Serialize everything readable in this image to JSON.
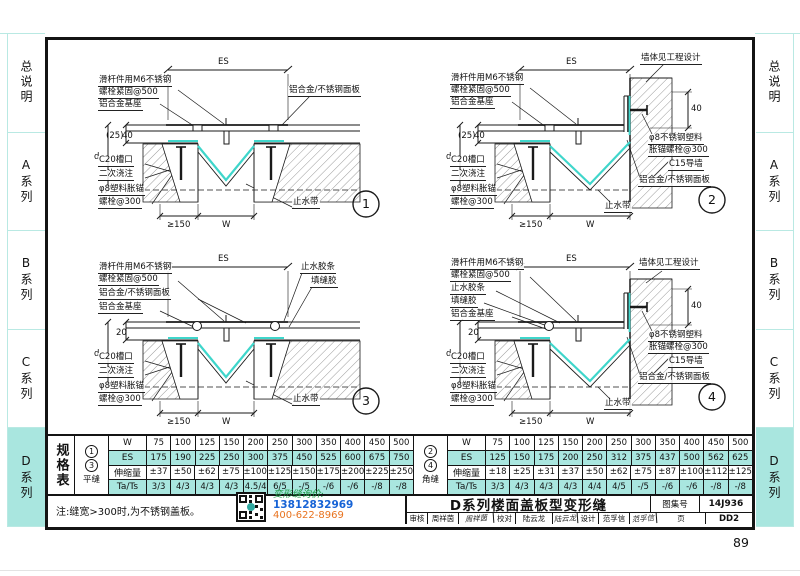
{
  "page_number": "89",
  "colors": {
    "accent_cyan": "#a9e6df",
    "waterstop_cyan": "#3fd6cb",
    "line_black": "#141414"
  },
  "sidebar": {
    "items": [
      {
        "label": "总说明",
        "active": false
      },
      {
        "label": "A系列",
        "active": false
      },
      {
        "label": "B系列",
        "active": false
      },
      {
        "label": "C系列",
        "active": false
      },
      {
        "label": "D系列",
        "active": true
      }
    ]
  },
  "details": [
    {
      "number": "1",
      "dims": {
        "es": "ES",
        "d": "d",
        "h1": "(25)",
        "h2": "40",
        "min": "≥150",
        "w": "W"
      },
      "labels": {
        "slider1": "滑杆件用M6不锈钢",
        "slider2": "螺栓紧固@500",
        "base": "铝合金基座",
        "panel": "铝合金/不锈钢面板",
        "notch": "C20槽口",
        "pour": "二次浇注",
        "anchor1": "φ8塑料胀锚",
        "anchor2": "螺栓@300",
        "waterstop": "止水带"
      }
    },
    {
      "number": "2",
      "dims": {
        "es": "ES",
        "d": "d",
        "h1": "(25)",
        "h2": "40",
        "wall_h": "40",
        "min": "≥150",
        "w": "W"
      },
      "labels": {
        "slider1": "滑杆件用M6不锈钢",
        "slider2": "螺栓紧固@500",
        "base": "铝合金基座",
        "wall": "墙体见工程设计",
        "wall_anchor1": "φ8不锈钢塑料",
        "wall_anchor2": "胀锚螺栓@300",
        "guide_wall": "C15导墙",
        "panel": "铝合金/不锈钢面板",
        "notch": "C20槽口",
        "pour": "二次浇注",
        "anchor1": "φ8塑料胀锚",
        "anchor2": "螺栓@300",
        "waterstop": "止水带"
      }
    },
    {
      "number": "3",
      "dims": {
        "es": "ES",
        "d": "d",
        "h1": "20",
        "min": "≥150",
        "w": "W"
      },
      "labels": {
        "slider1": "滑杆件用M6不锈钢",
        "slider2": "螺栓紧固@500",
        "panel": "铝合金/不锈钢面板",
        "base": "铝合金基座",
        "seal": "止水胶条",
        "caulk": "填缝胶",
        "notch": "C20槽口",
        "pour": "二次浇注",
        "anchor1": "φ8塑料胀锚",
        "anchor2": "螺栓@300",
        "waterstop": "止水带"
      }
    },
    {
      "number": "4",
      "dims": {
        "es": "ES",
        "d": "d",
        "h1": "20",
        "wall_h": "40",
        "min": "≥150",
        "w": "W"
      },
      "labels": {
        "slider1": "滑杆件用M6不锈钢",
        "slider2": "螺栓紧固@500",
        "seal": "止水胶条",
        "caulk": "填缝胶",
        "base": "铝合金基座",
        "wall": "墙体见工程设计",
        "wall_anchor1": "φ8不锈钢塑料",
        "wall_anchor2": "胀锚螺栓@300",
        "guide_wall": "C15导墙",
        "panel": "铝合金/不锈钢面板",
        "notch": "C20槽口",
        "pour": "二次浇注",
        "anchor1": "φ8塑料胀锚",
        "anchor2": "螺栓@300",
        "waterstop": "止水带"
      }
    }
  ],
  "spec_table": {
    "title": "规格表",
    "groups": [
      {
        "marks": [
          "1",
          "3"
        ],
        "type_label": "平缝",
        "rows": [
          {
            "label": "W",
            "values": [
              "75",
              "100",
              "125",
              "150",
              "200",
              "250",
              "300",
              "350",
              "400",
              "450",
              "500"
            ]
          },
          {
            "label": "ES",
            "values": [
              "175",
              "190",
              "225",
              "250",
              "300",
              "375",
              "450",
              "525",
              "600",
              "675",
              "750"
            ]
          },
          {
            "label": "伸缩量",
            "values": [
              "±37",
              "±50",
              "±62",
              "±75",
              "±100",
              "±125",
              "±150",
              "±175",
              "±200",
              "±225",
              "±250"
            ]
          },
          {
            "label": "Ta/Ts",
            "values": [
              "3/3",
              "4/3",
              "4/3",
              "4/3",
              "4.5/4",
              "6/5",
              "-/5",
              "-/6",
              "-/6",
              "-/8",
              "-/8"
            ]
          }
        ]
      },
      {
        "marks": [
          "2",
          "4"
        ],
        "type_label": "角缝",
        "rows": [
          {
            "label": "W",
            "values": [
              "75",
              "100",
              "125",
              "150",
              "200",
              "250",
              "300",
              "350",
              "400",
              "450",
              "500"
            ]
          },
          {
            "label": "ES",
            "values": [
              "125",
              "150",
              "175",
              "200",
              "250",
              "312",
              "375",
              "437",
              "500",
              "562",
              "625"
            ]
          },
          {
            "label": "伸缩量",
            "values": [
              "±18",
              "±25",
              "±31",
              "±37",
              "±50",
              "±62",
              "±75",
              "±87",
              "±100",
              "±112",
              "±125"
            ]
          },
          {
            "label": "Ta/Ts",
            "values": [
              "3/3",
              "4/3",
              "4/3",
              "4/3",
              "4/4",
              "4/5",
              "-/5",
              "-/6",
              "-/6",
              "-/8",
              "-/8"
            ]
          }
        ]
      }
    ]
  },
  "note": "注:缝宽>300时,为不锈钢盖板。",
  "watermark": {
    "line1": "变形缝询价:",
    "phone1": "13812832969",
    "phone2": "400-622-8969"
  },
  "title_block": {
    "title": "D系列楼面盖板型变形缝",
    "atlas_label": "图集号",
    "atlas_no": "14J936",
    "page_label": "页",
    "page_no": "DD2",
    "reviewer_label": "审核",
    "reviewer": "周祥茵",
    "reviewer_sig": "周祥茵",
    "checker_label": "校对",
    "checker": "陆云龙",
    "checker_sig": "陆云龙",
    "designer_label": "设计",
    "designer": "范孚信",
    "designer_sig": "范孚信"
  }
}
